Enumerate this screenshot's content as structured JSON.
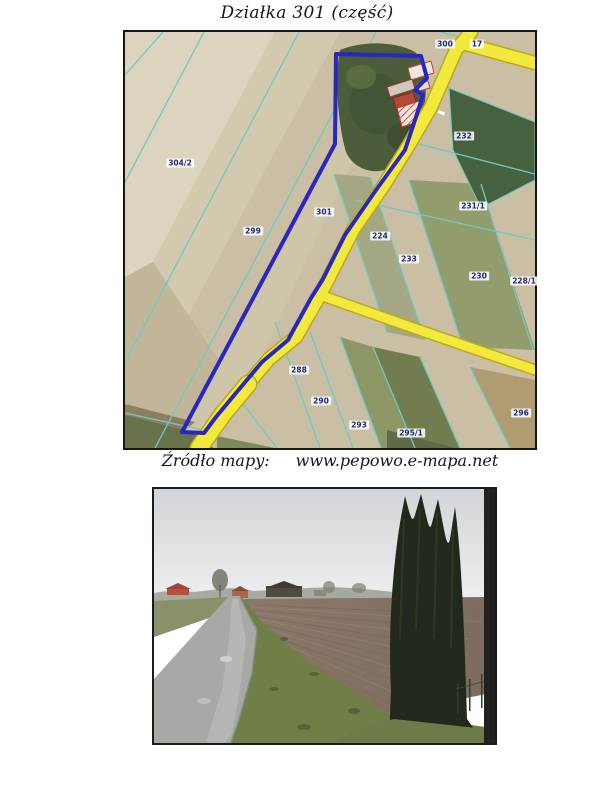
{
  "title": "Działka 301 (część)",
  "map": {
    "caption_label": "Źródło mapy:",
    "caption_url": "www.pepowo.e-mapa.net",
    "highlighted_plot": "301",
    "colors": {
      "plot_outline": "#2a26bf",
      "road_fill": "#f3e93c",
      "road_edge": "#b9a91f",
      "boundary_line": "#6ecac2",
      "label_text": "#1d2a78"
    },
    "parcels": [
      {
        "label": "304/2",
        "x": 55,
        "y": 131
      },
      {
        "label": "299",
        "x": 128,
        "y": 199
      },
      {
        "label": "301",
        "x": 199,
        "y": 180
      },
      {
        "label": "300",
        "x": 320,
        "y": 12
      },
      {
        "label": "17",
        "x": 352,
        "y": 12
      },
      {
        "label": "232",
        "x": 339,
        "y": 104
      },
      {
        "label": "231/1",
        "x": 348,
        "y": 174
      },
      {
        "label": "224",
        "x": 255,
        "y": 204
      },
      {
        "label": "233",
        "x": 284,
        "y": 227
      },
      {
        "label": "230",
        "x": 354,
        "y": 244
      },
      {
        "label": "228/1",
        "x": 399,
        "y": 249
      },
      {
        "label": "288",
        "x": 174,
        "y": 338
      },
      {
        "label": "290",
        "x": 196,
        "y": 369
      },
      {
        "label": "293",
        "x": 234,
        "y": 393
      },
      {
        "label": "295/1",
        "x": 286,
        "y": 401
      },
      {
        "label": "296",
        "x": 396,
        "y": 381
      }
    ]
  }
}
